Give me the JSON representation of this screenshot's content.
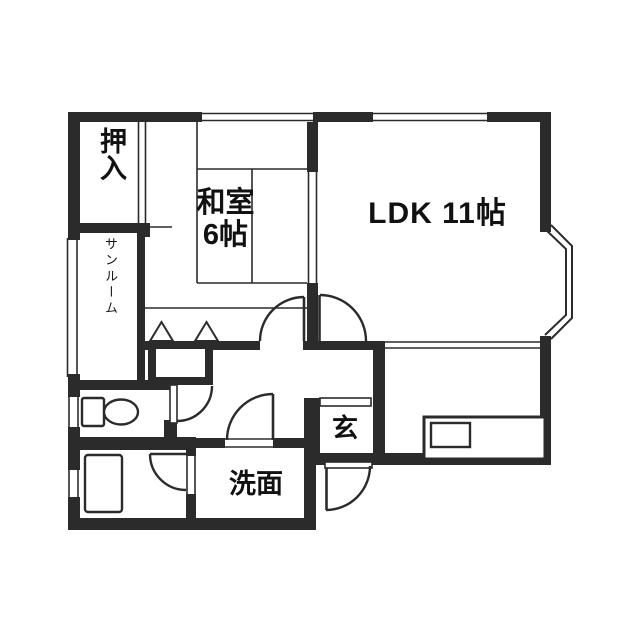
{
  "colors": {
    "wall": "#2b2b2b",
    "background": "#ffffff",
    "text": "#111111"
  },
  "rooms": {
    "oshiire": {
      "label": "押入"
    },
    "sunroom": {
      "label": "サンルーム"
    },
    "washitsu": {
      "name_label": "和室",
      "size_label": "6帖"
    },
    "ldk": {
      "label": "LDK 11帖"
    },
    "genkan": {
      "label": "玄"
    },
    "senmen": {
      "label": "洗面"
    }
  },
  "fixtures": {
    "toilet": "toilet-icon",
    "bathtub": "bathtub-icon",
    "kitchen_counter": "kitchen-counter-icon",
    "kitchen_sink": "kitchen-sink-icon",
    "bay_window": "bay-window",
    "entrance_door": "entrance-door-arc",
    "genkan_step": "genkan-step",
    "hall_storage": "hall-storage-box",
    "folding_door_markers": "folding-door-triangles"
  }
}
